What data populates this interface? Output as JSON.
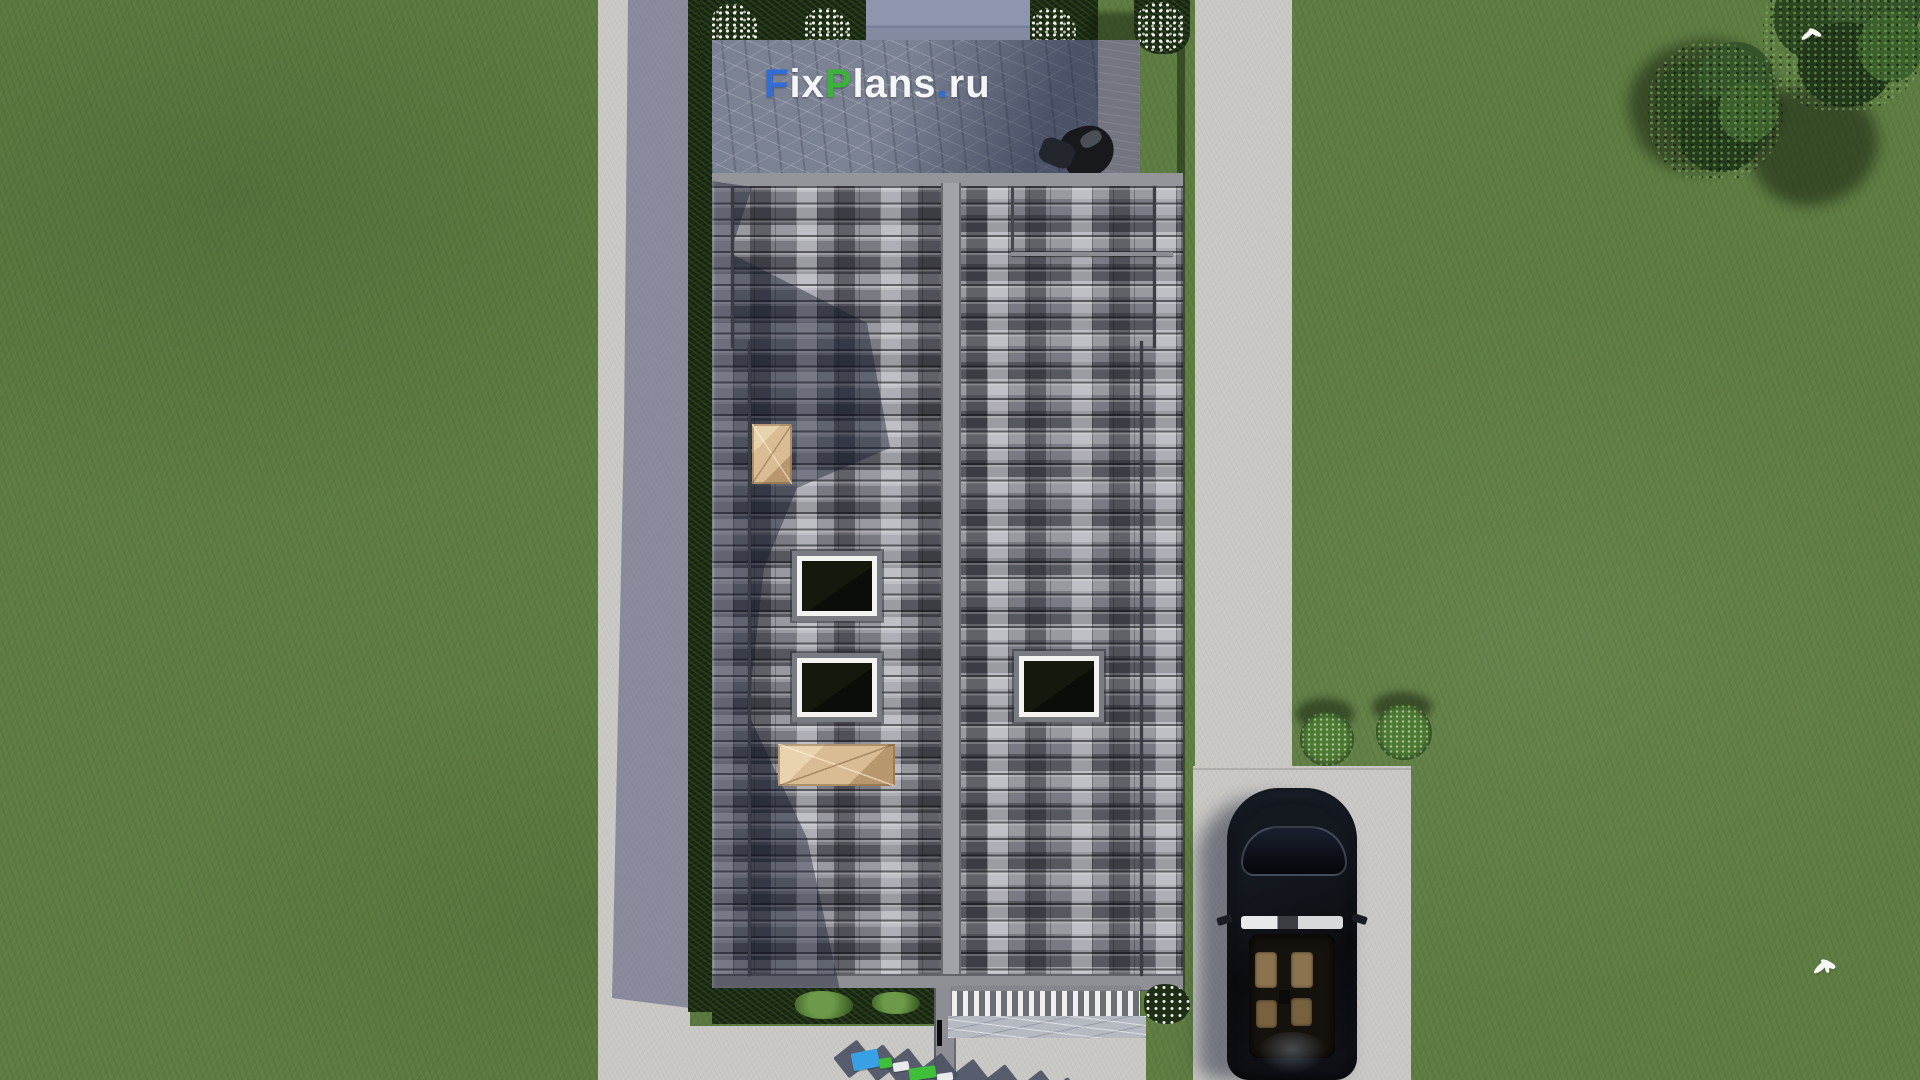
{
  "site_watermark": {
    "text": "FixPlans.ru",
    "segments": [
      {
        "text": "F",
        "css": "color:#2f6ddb"
      },
      {
        "text": "ix",
        "css": "color:#f4f5f7"
      },
      {
        "text": "P",
        "css": "color:#3bb33b"
      },
      {
        "text": "lans",
        "css": "color:#f4f5f7"
      },
      {
        "text": ".",
        "css": "color:#2f6ddb"
      },
      {
        "text": "ru",
        "css": "color:#f4f5f7"
      }
    ]
  },
  "ground_watermark": {
    "text": "FixPlans.ru",
    "appearance": "3d-extruded-letters-partially-cropped",
    "colors": [
      "#38a0e4",
      "#3fbf3a",
      "#e9eaec",
      "#4a5163"
    ]
  },
  "palette": {
    "grass": "#5e7d41",
    "roof_base": "#73747c",
    "roof_tile_light": "#b8b9bf",
    "roof_tile_dark": "#34353c",
    "roof_ridge": "#a2a3a8",
    "path": "#c9c8c4",
    "patio_stone": "#7b8294",
    "hedge": "#1c2b13",
    "chimney_wood": "#d9bb94",
    "skylight_frame": "#f2f2f0",
    "car_body": "#0d0e12",
    "car_seats": "#8a734e",
    "accent_blue": "#2f6ddb",
    "accent_green": "#3bb33b"
  }
}
